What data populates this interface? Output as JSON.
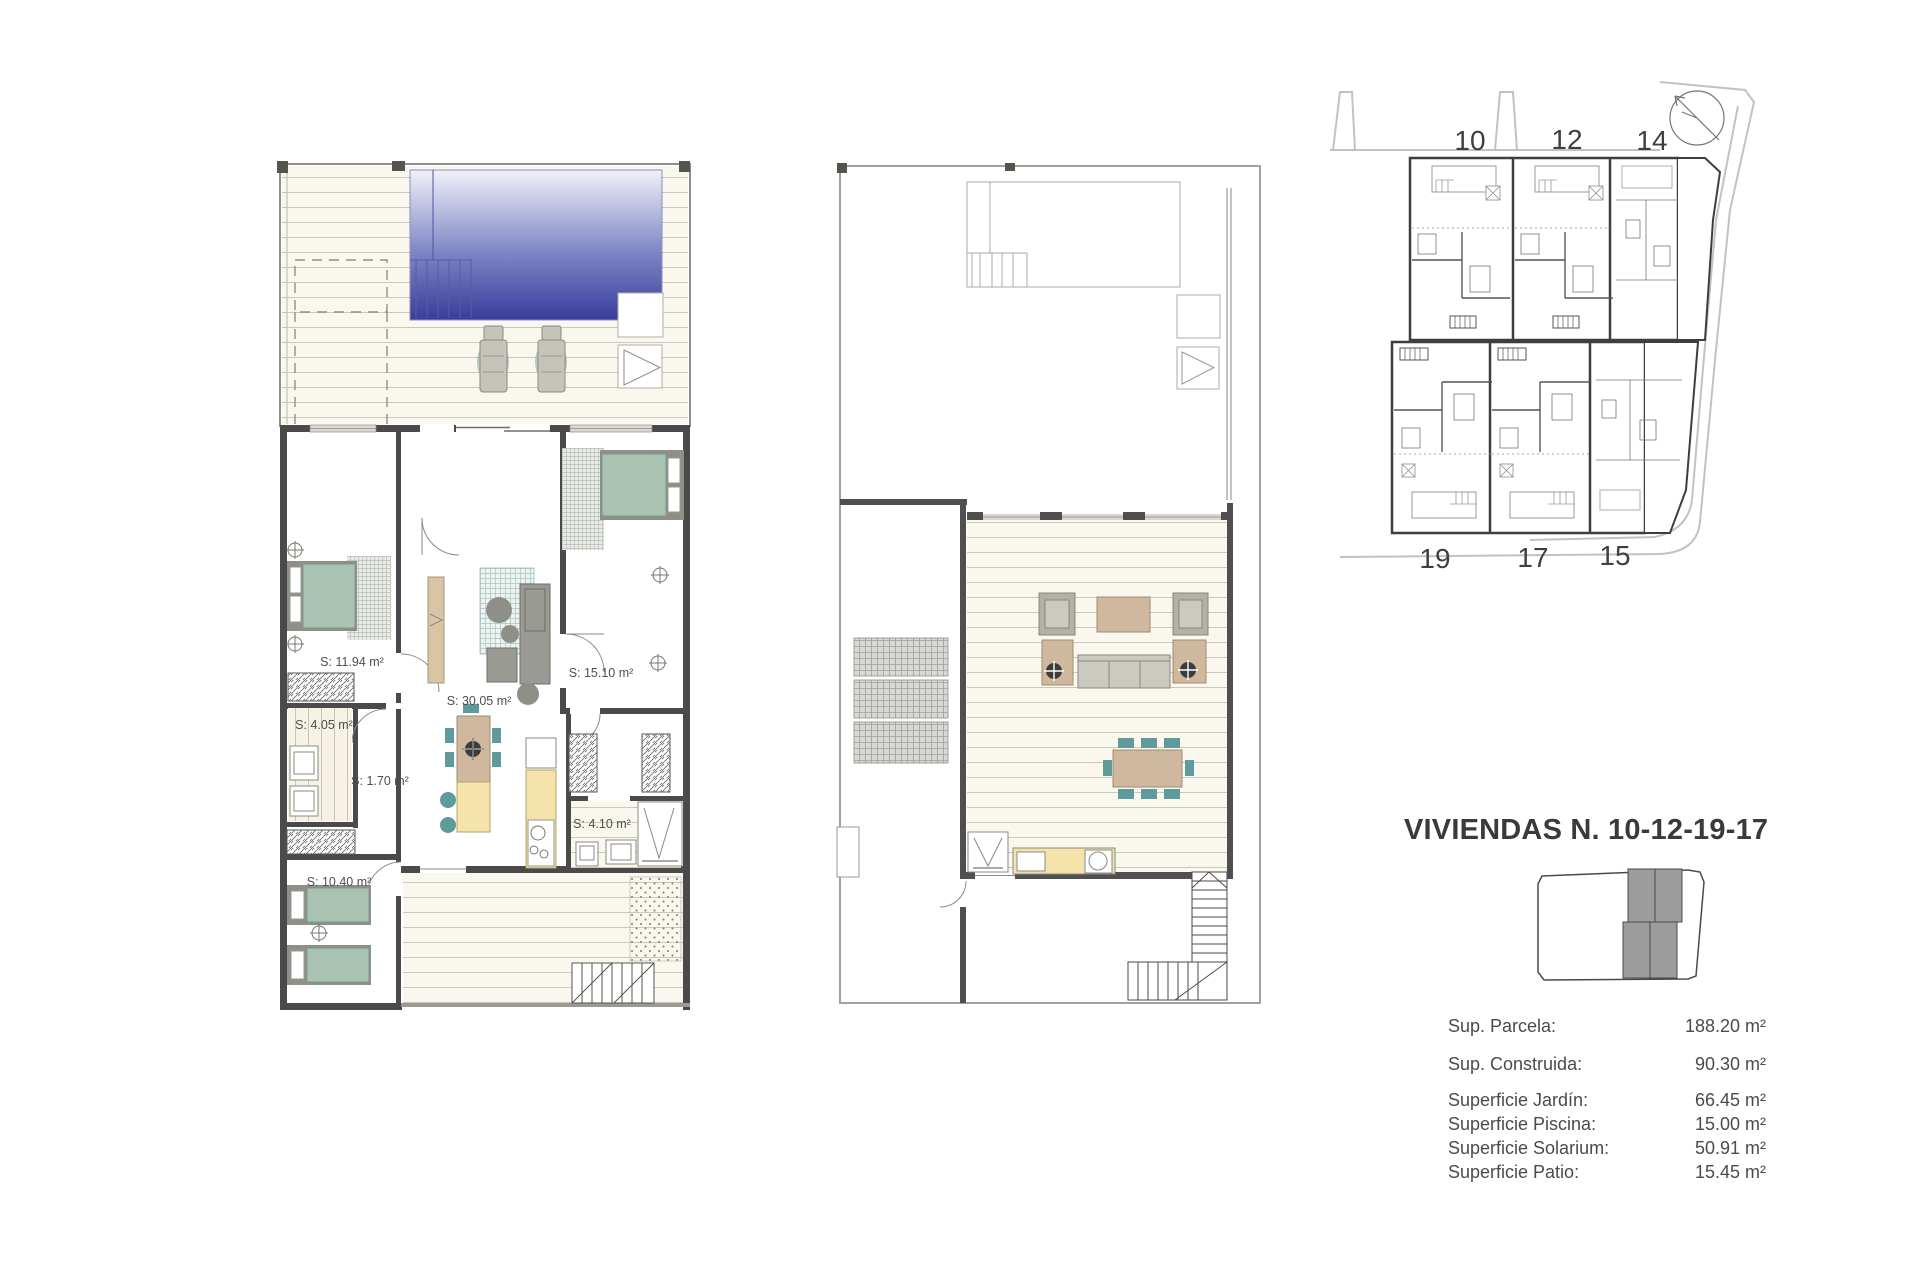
{
  "title": "VIVIENDAS N. 10-12-19-17",
  "ground_floor": {
    "rooms": {
      "bedroom_main": "S: 11.94 m²",
      "laundry": "S: 4.05 m²",
      "hall": "S: 1.70 m²",
      "living_kitchen": "S: 30.05 m²",
      "bedroom_double": "S: 15.10 m²",
      "bathroom": "S: 4.10 m²",
      "bedroom_twin": "S: 10.40 m²"
    }
  },
  "site_plan": {
    "units_top": [
      "10",
      "12",
      "14"
    ],
    "units_bottom": [
      "19",
      "17",
      "15"
    ]
  },
  "summary": {
    "rows": [
      {
        "label": "Sup. Parcela:",
        "value": "188.20 m²"
      },
      {
        "label": "Sup. Construida:",
        "value": "90.30 m²"
      },
      {
        "label": "Superficie Jardín:",
        "value": "66.45 m²"
      },
      {
        "label": "Superficie Piscina:",
        "value": "15.00 m²"
      },
      {
        "label": "Superficie Solarium:",
        "value": "50.91 m²"
      },
      {
        "label": "Superficie Patio:",
        "value": "15.45 m²"
      }
    ]
  },
  "colors": {
    "pool_top": "#f0f1f9",
    "pool_mid": "#7d86c4",
    "pool_deep": "#383d9a",
    "bed_green": "#a9c3b2",
    "chair_teal": "#5f9a9c",
    "furn_tan": "#cfb89e",
    "counter_yellow": "#f5e3ab",
    "wall_dark": "#4a4a4a",
    "deck_cream": "#faf8ee"
  }
}
